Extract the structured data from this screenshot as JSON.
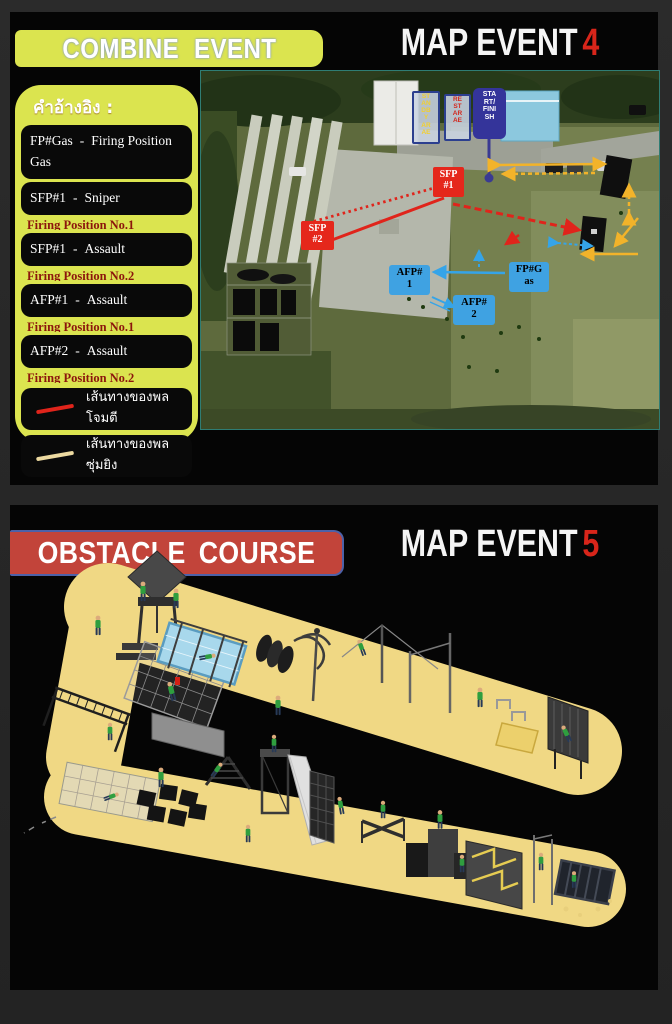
{
  "slide1": {
    "banner_label": "COMBINE EVENT",
    "title": "MAP EVENT",
    "title_number": "4",
    "legend": {
      "title": "คำอ้างอิง :",
      "entries": [
        {
          "code": "FP#Gas",
          "sep": "-",
          "desc": "Firing Position Gas"
        },
        {
          "code": "SFP#1",
          "sep": "-",
          "desc": "Sniper"
        },
        {
          "code": "SFP#1",
          "sep": "-",
          "desc": "Assault"
        },
        {
          "code": "AFP#1",
          "sep": "-",
          "desc": "Assault"
        },
        {
          "code": "AFP#2",
          "sep": "-",
          "desc": "Assault"
        }
      ],
      "refs": [
        "Firing Position No.1",
        "Firing Position No.2",
        "Firing Position No.1",
        "Firing Position No.2"
      ],
      "routes": [
        {
          "label": "เส้นทางของพลโจมตี"
        },
        {
          "label": "เส้นทางของพลซุ่มยิง"
        }
      ]
    },
    "map": {
      "standby_area": "ST\nAN\nDB\nY\nAR\nAE",
      "rest_area": "RE\nST\nAR\nAE",
      "start_finish": "STA\nRT/\nFINI\nSH",
      "sfp1": "SFP\n#1",
      "sfp2": "SFP\n#2",
      "afp1": "AFP#\n1",
      "afp2": "AFP#\n2",
      "fp_gas": "FP#G\nas"
    }
  },
  "slide2": {
    "banner_label": "OBSTACLE COURSE",
    "title": "MAP EVENT",
    "title_number": "5"
  },
  "colors": {
    "banner_yellow": "#dbe44f",
    "banner_red": "#c2443a",
    "banner_red_border": "#4d61a8",
    "title_number_red": "#d8251a",
    "map_red_box": "#e5271b",
    "map_blue_box": "#3fa2e2",
    "start_finish_navy": "#34349a",
    "route_assault_red": "#e0241b",
    "route_sniper_tan": "#ecd9a0",
    "course_sand": "#f0d884"
  }
}
